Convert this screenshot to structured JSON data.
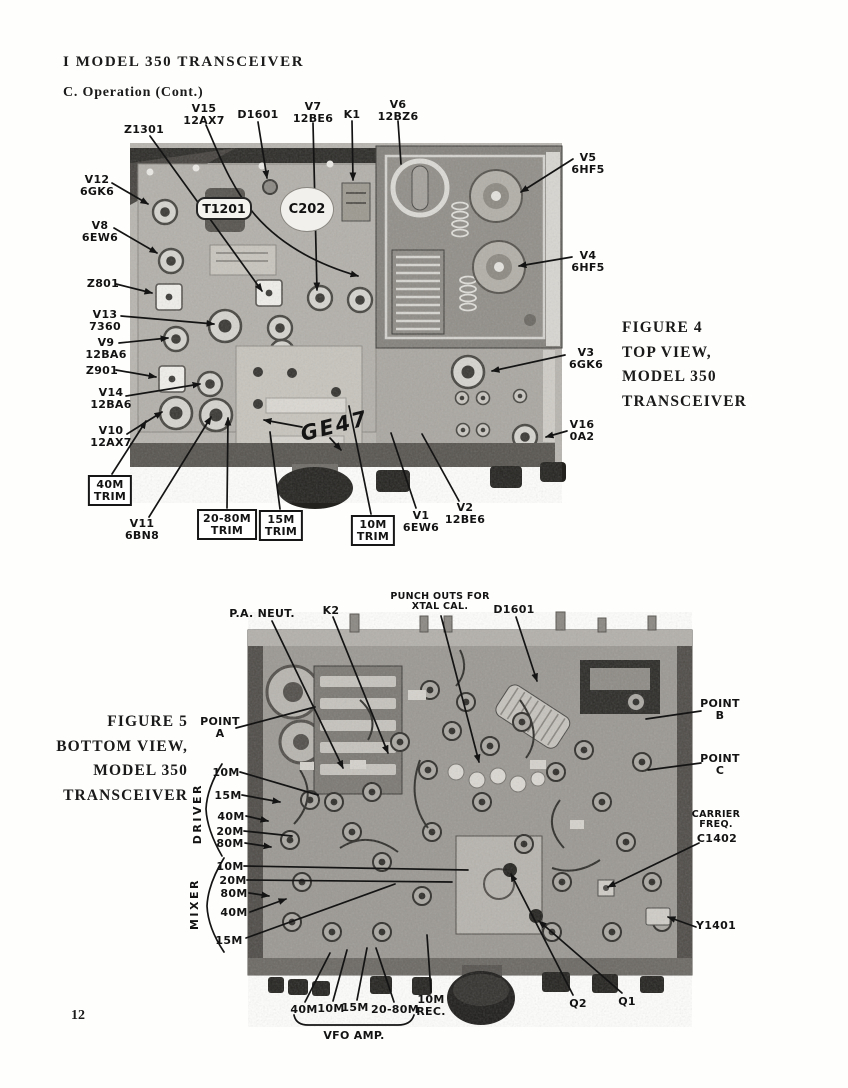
{
  "page": {
    "header_title": "I MODEL 350 TRANSCEIVER",
    "header_subtitle": "C. Operation (Cont.)",
    "page_number": "12"
  },
  "figure4": {
    "caption": "FIGURE 4\nTOP VIEW,\nMODEL 350\nTRANSCEIVER",
    "photo_annotations": {
      "t1201": "T1201",
      "c202": "C202",
      "ge47": "GE47"
    },
    "callouts": {
      "z1301": "Z1301",
      "v15": "V15\n12AX7",
      "d1601": "D1601",
      "v7": "V7\n12BE6",
      "k1": "K1",
      "v6": "V6\n12BZ6",
      "v12": "V12\n6GK6",
      "v8": "V8\n6EW6",
      "z801": "Z801",
      "v13": "V13\n7360",
      "v9": "V9\n12BA6",
      "z901": "Z901",
      "v14": "V14\n12BA6",
      "v10": "V10\n12AX7",
      "trim_40m": "40M\nTRIM",
      "v11": "V11\n6BN8",
      "trim_20_80m": "20-80M\nTRIM",
      "trim_15m": "15M\nTRIM",
      "trim_10m": "10M\nTRIM",
      "v1": "V1\n6EW6",
      "v2": "V2\n12BE6",
      "v5": "V5\n6HF5",
      "v4": "V4\n6HF5",
      "v3": "V3\n6GK6",
      "v16": "V16\n0A2"
    }
  },
  "figure5": {
    "caption": "FIGURE 5\nBOTTOM VIEW,\nMODEL 350\nTRANSCEIVER",
    "callouts": {
      "pa_neut": "P.A. NEUT.",
      "k2": "K2",
      "punch_outs": "PUNCH OUTS FOR\nXTAL CAL.",
      "d1601": "D1601",
      "point_a": "POINT\nA",
      "point_b": "POINT\nB",
      "point_c": "POINT\nC",
      "carrier_freq": "CARRIER\nFREQ.",
      "c1402": "C1402",
      "y1401": "Y1401",
      "rec_10m": "10M\nREC.",
      "vfo_amp": "VFO AMP.",
      "q2": "Q2",
      "q1": "Q1"
    },
    "driver_group": {
      "label": "DRIVER",
      "items": [
        "10M",
        "15M",
        "40M",
        "20M",
        "80M"
      ]
    },
    "mixer_group": {
      "label": "MIXER",
      "items": [
        "10M",
        "20M",
        "80M",
        "40M",
        "15M"
      ]
    },
    "vfo_amp_group": {
      "items": [
        "40M",
        "10M",
        "15M",
        "20-80M"
      ]
    }
  }
}
